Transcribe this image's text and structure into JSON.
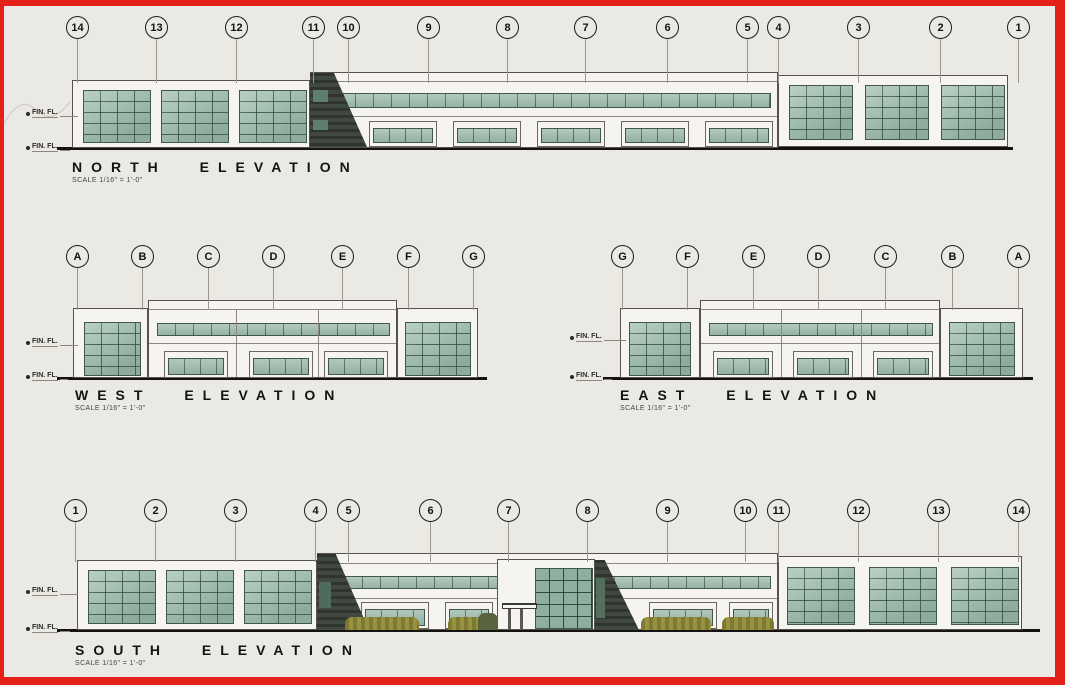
{
  "sheet": {
    "frame_color": "#e32119",
    "paper_color": "#eae9e4"
  },
  "colors": {
    "frame": "#e32119",
    "paper": "#eae9e4",
    "glass": "#a6c1b3",
    "glass_dark": "#8fb0a1",
    "shadow": "#41483f",
    "bush": "#96923f"
  },
  "labels": {
    "fin_fl": "FIN. FL."
  },
  "elevations": {
    "north": {
      "title": "NORTH ELEVATION",
      "scale_note": "SCALE 1/16\" = 1'-0\"",
      "bubbles": [
        {
          "label": "14",
          "x": 77
        },
        {
          "label": "13",
          "x": 156
        },
        {
          "label": "12",
          "x": 236
        },
        {
          "label": "11",
          "x": 313
        },
        {
          "label": "10",
          "x": 348
        },
        {
          "label": "9",
          "x": 428
        },
        {
          "label": "8",
          "x": 507
        },
        {
          "label": "7",
          "x": 585
        },
        {
          "label": "6",
          "x": 667
        },
        {
          "label": "5",
          "x": 747
        },
        {
          "label": "4",
          "x": 778
        },
        {
          "label": "3",
          "x": 858
        },
        {
          "label": "2",
          "x": 940
        },
        {
          "label": "1",
          "x": 1018
        }
      ]
    },
    "west": {
      "title": "WEST ELEVATION",
      "scale_note": "SCALE 1/16\" = 1'-0\"",
      "bubbles": [
        {
          "label": "A",
          "x": 77
        },
        {
          "label": "B",
          "x": 142
        },
        {
          "label": "C",
          "x": 208
        },
        {
          "label": "D",
          "x": 273
        },
        {
          "label": "E",
          "x": 342
        },
        {
          "label": "F",
          "x": 408
        },
        {
          "label": "G",
          "x": 473
        }
      ]
    },
    "east": {
      "title": "EAST ELEVATION",
      "scale_note": "SCALE 1/16\" = 1'-0\"",
      "bubbles": [
        {
          "label": "G",
          "x": 622
        },
        {
          "label": "F",
          "x": 687
        },
        {
          "label": "E",
          "x": 753
        },
        {
          "label": "D",
          "x": 818
        },
        {
          "label": "C",
          "x": 885
        },
        {
          "label": "B",
          "x": 952
        },
        {
          "label": "A",
          "x": 1018
        }
      ]
    },
    "south": {
      "title": "SOUTH ELEVATION",
      "scale_note": "SCALE 1/16\" = 1'-0\"",
      "bubbles": [
        {
          "label": "1",
          "x": 75
        },
        {
          "label": "2",
          "x": 155
        },
        {
          "label": "3",
          "x": 235
        },
        {
          "label": "4",
          "x": 315
        },
        {
          "label": "5",
          "x": 348
        },
        {
          "label": "6",
          "x": 430
        },
        {
          "label": "7",
          "x": 508
        },
        {
          "label": "8",
          "x": 587
        },
        {
          "label": "9",
          "x": 667
        },
        {
          "label": "10",
          "x": 745
        },
        {
          "label": "11",
          "x": 778
        },
        {
          "label": "12",
          "x": 858
        },
        {
          "label": "13",
          "x": 938
        },
        {
          "label": "14",
          "x": 1018
        }
      ]
    }
  }
}
